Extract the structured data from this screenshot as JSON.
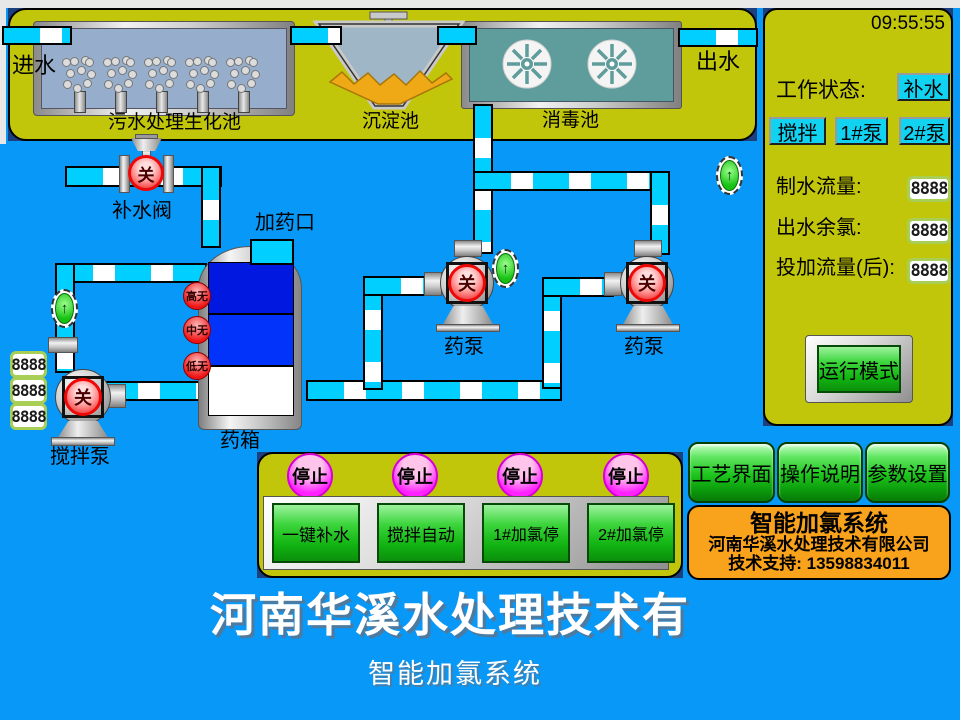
{
  "header": {
    "time": "09:55:55"
  },
  "icons": {
    "up_arrow": "↑"
  },
  "plant": {
    "inlet_label": "进水",
    "outlet_label": "出水",
    "pools": [
      {
        "label": "污水处理生化池"
      },
      {
        "label": "沉淀池"
      },
      {
        "label": "消毒池"
      }
    ]
  },
  "diagram": {
    "supply_valve_label": "补水阀",
    "dosing_port_label": "加药口",
    "tank_label": "药箱",
    "levels": [
      "高无",
      "中无",
      "低无"
    ],
    "states": {
      "valve": "关",
      "stir_pump": "关",
      "dosing_pump1": "关",
      "dosing_pump2": "关"
    },
    "pump_labels": {
      "stir": "搅拌泵",
      "dosing1": "药泵",
      "dosing2": "药泵"
    },
    "left_displays": [
      "8888",
      "8888",
      "8888"
    ]
  },
  "status_panel": {
    "work_status_label": "工作状态:",
    "status_buttons": [
      "补水",
      "搅拌",
      "1#泵",
      "2#泵"
    ],
    "metrics": [
      {
        "label": "制水流量:",
        "value": "8888"
      },
      {
        "label": "出水余氯:",
        "value": "8888"
      },
      {
        "label": "投加流量(后):",
        "value": "8888"
      }
    ],
    "run_mode_button": "运行模式"
  },
  "control_panel": {
    "groups": [
      {
        "stop": "停止",
        "button": "一键补水"
      },
      {
        "stop": "停止",
        "button": "搅拌自动"
      },
      {
        "stop": "停止",
        "button": "1#加氯停"
      },
      {
        "stop": "停止",
        "button": "2#加氯停"
      }
    ]
  },
  "nav": {
    "buttons": [
      "工艺界面",
      "操作说明",
      "参数设置"
    ]
  },
  "company_box": {
    "title": "智能加氯系统",
    "company": "河南华溪水处理技术有限公司",
    "support": "技术支持: 13598834011"
  },
  "footer": {
    "title": "河南华溪水处理技术有",
    "subtitle": "智能加氯系统"
  }
}
